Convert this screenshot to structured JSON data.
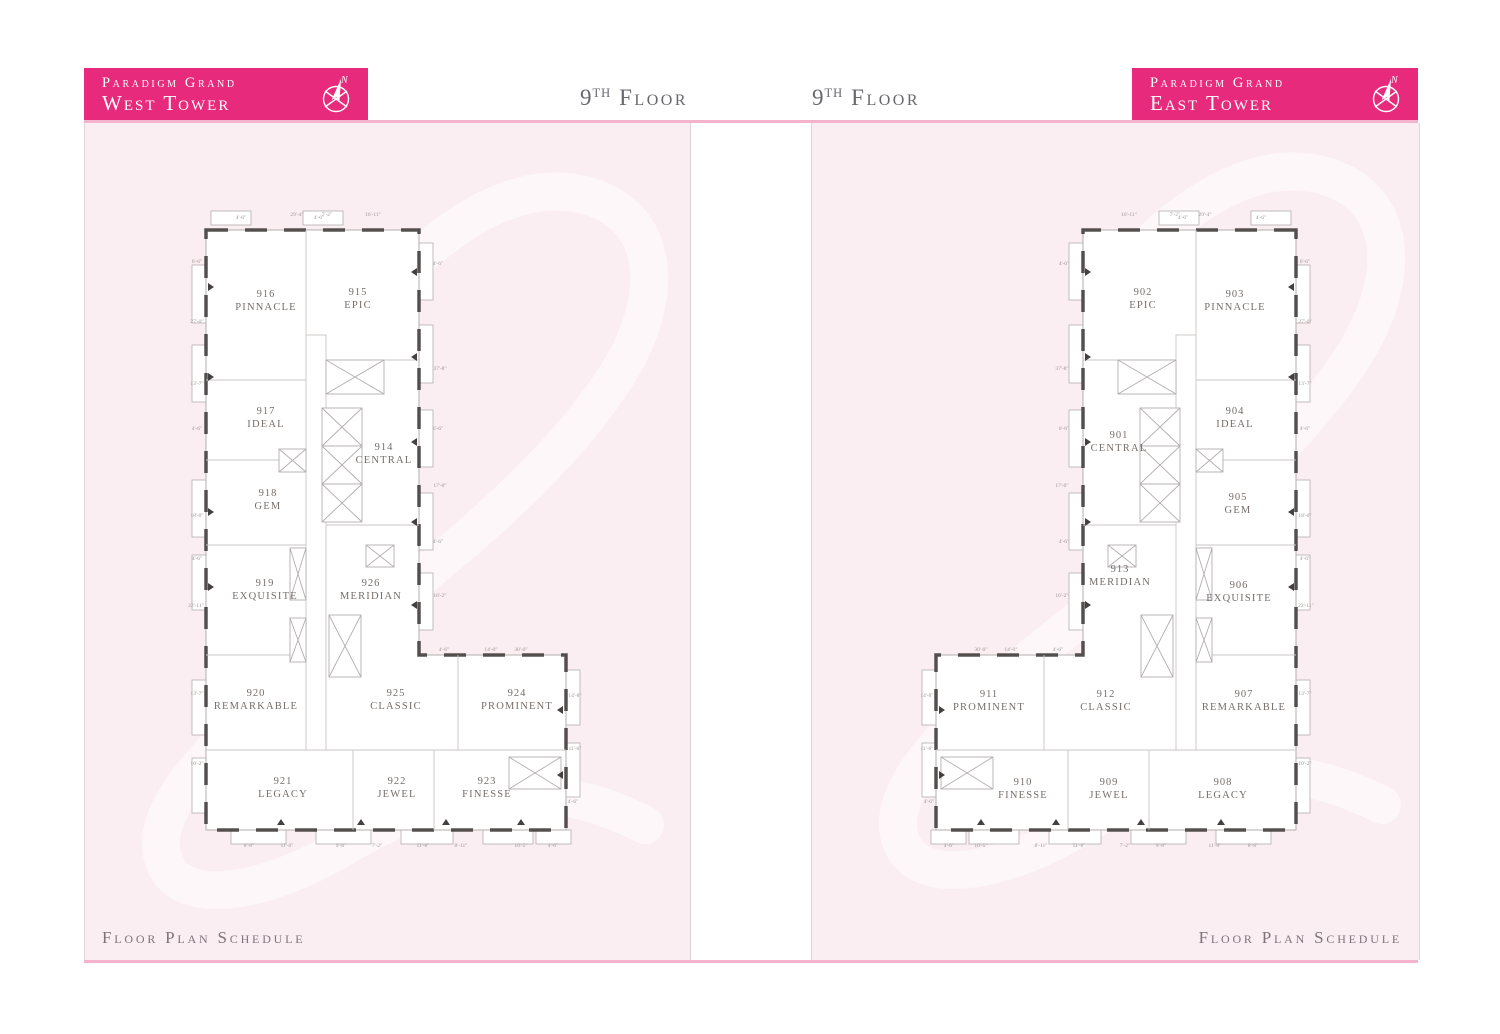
{
  "palette": {
    "banner": "#e72a7c",
    "panel_bg": "#fbeef3",
    "pink_line": "#f3b3cd",
    "wall_gray": "#b3aeae",
    "wall_dark": "#454040",
    "room_line": "#cac5c5",
    "label": "#756e6a",
    "dim": "#9b9592",
    "title": "#68676c",
    "footer": "#7c747a",
    "watermark": "rgba(255,255,255,0.55)"
  },
  "header": {
    "west_banner": {
      "line1": "Paradigm Grand",
      "line2": "West Tower"
    },
    "east_banner": {
      "line1": "Paradigm Grand",
      "line2": "East Tower"
    },
    "compass_label": "N",
    "floor_title_left": {
      "number": "9",
      "ordinal": "th",
      "word": "Floor"
    },
    "floor_title_right": {
      "number": "9",
      "ordinal": "th",
      "word": "Floor"
    }
  },
  "footer": {
    "west": "Floor Plan Schedule",
    "east": "Floor Plan Schedule"
  },
  "west_tower": {
    "rooms": [
      {
        "number": "916",
        "name": "PINNACLE",
        "x": 75,
        "y": 77
      },
      {
        "number": "915",
        "name": "EPIC",
        "x": 167,
        "y": 75
      },
      {
        "number": "917",
        "name": "IDEAL",
        "x": 75,
        "y": 194
      },
      {
        "number": "914",
        "name": "CENTRAL",
        "x": 193,
        "y": 230
      },
      {
        "number": "918",
        "name": "GEM",
        "x": 77,
        "y": 276
      },
      {
        "number": "919",
        "name": "EXQUISITE",
        "x": 74,
        "y": 366
      },
      {
        "number": "926",
        "name": "MERIDIAN",
        "x": 180,
        "y": 366
      },
      {
        "number": "920",
        "name": "REMARKABLE",
        "x": 65,
        "y": 476
      },
      {
        "number": "925",
        "name": "CLASSIC",
        "x": 205,
        "y": 476
      },
      {
        "number": "924",
        "name": "PROMINENT",
        "x": 326,
        "y": 476
      },
      {
        "number": "921",
        "name": "LEGACY",
        "x": 92,
        "y": 564
      },
      {
        "number": "922",
        "name": "JEWEL",
        "x": 206,
        "y": 564
      },
      {
        "number": "923",
        "name": "FINESSE",
        "x": 296,
        "y": 564
      }
    ]
  },
  "east_tower": {
    "rooms": [
      {
        "number": "902",
        "name": "EPIC",
        "x": 222,
        "y": 75
      },
      {
        "number": "903",
        "name": "PINNACLE",
        "x": 314,
        "y": 77
      },
      {
        "number": "901",
        "name": "CENTRAL",
        "x": 198,
        "y": 218
      },
      {
        "number": "904",
        "name": "IDEAL",
        "x": 314,
        "y": 194
      },
      {
        "number": "905",
        "name": "GEM",
        "x": 317,
        "y": 280
      },
      {
        "number": "913",
        "name": "MERIDIAN",
        "x": 199,
        "y": 352
      },
      {
        "number": "906",
        "name": "EXQUISITE",
        "x": 318,
        "y": 368
      },
      {
        "number": "911",
        "name": "PROMINENT",
        "x": 68,
        "y": 477
      },
      {
        "number": "912",
        "name": "CLASSIC",
        "x": 185,
        "y": 477
      },
      {
        "number": "907",
        "name": "REMARKABLE",
        "x": 323,
        "y": 477
      },
      {
        "number": "910",
        "name": "FINESSE",
        "x": 102,
        "y": 565
      },
      {
        "number": "909",
        "name": "JEWEL",
        "x": 188,
        "y": 565
      },
      {
        "number": "908",
        "name": "LEGACY",
        "x": 302,
        "y": 565
      }
    ]
  },
  "dimensions": [
    {
      "x": 50,
      "y": -6,
      "t": "4'-6\""
    },
    {
      "x": 106,
      "y": -9,
      "t": "29'-4\""
    },
    {
      "x": 136,
      "y": -9,
      "t": "7'-2\""
    },
    {
      "x": 182,
      "y": -9,
      "t": "16'-11\""
    },
    {
      "x": 128,
      "y": -6,
      "t": "4'-6\""
    },
    {
      "x": 6,
      "y": 38,
      "t": "6'-6\""
    },
    {
      "x": 6,
      "y": 98,
      "t": "27'-0\""
    },
    {
      "x": 6,
      "y": 160,
      "t": "13'-7\""
    },
    {
      "x": 6,
      "y": 205,
      "t": "4'-6\""
    },
    {
      "x": 6,
      "y": 292,
      "t": "18'-0\""
    },
    {
      "x": 6,
      "y": 335,
      "t": "4'-6\""
    },
    {
      "x": 5,
      "y": 382,
      "t": "22'-11\""
    },
    {
      "x": 6,
      "y": 470,
      "t": "13'-7\""
    },
    {
      "x": 6,
      "y": 540,
      "t": "10'-2\""
    },
    {
      "x": 247,
      "y": 40,
      "t": "4'-6\""
    },
    {
      "x": 249,
      "y": 145,
      "t": "37'-8\""
    },
    {
      "x": 247,
      "y": 205,
      "t": "6'-6\""
    },
    {
      "x": 249,
      "y": 262,
      "t": "17'-0\""
    },
    {
      "x": 247,
      "y": 318,
      "t": "4'-6\""
    },
    {
      "x": 249,
      "y": 372,
      "t": "16'-2\""
    },
    {
      "x": 384,
      "y": 472,
      "t": "14'-8\""
    },
    {
      "x": 384,
      "y": 525,
      "t": "11'-6\""
    },
    {
      "x": 382,
      "y": 578,
      "t": "4'-6\""
    },
    {
      "x": 253,
      "y": 426,
      "t": "4'-6\""
    },
    {
      "x": 300,
      "y": 426,
      "t": "14'-0\""
    },
    {
      "x": 330,
      "y": 426,
      "t": "30'-0\""
    },
    {
      "x": 58,
      "y": 622,
      "t": "8'-8\""
    },
    {
      "x": 96,
      "y": 622,
      "t": "11'-0\""
    },
    {
      "x": 150,
      "y": 622,
      "t": "9'-8\""
    },
    {
      "x": 186,
      "y": 622,
      "t": "7'-2\""
    },
    {
      "x": 232,
      "y": 622,
      "t": "11'-8\""
    },
    {
      "x": 270,
      "y": 622,
      "t": "8'-11\""
    },
    {
      "x": 330,
      "y": 622,
      "t": "10'-5\""
    },
    {
      "x": 362,
      "y": 622,
      "t": "4'-6\""
    }
  ]
}
